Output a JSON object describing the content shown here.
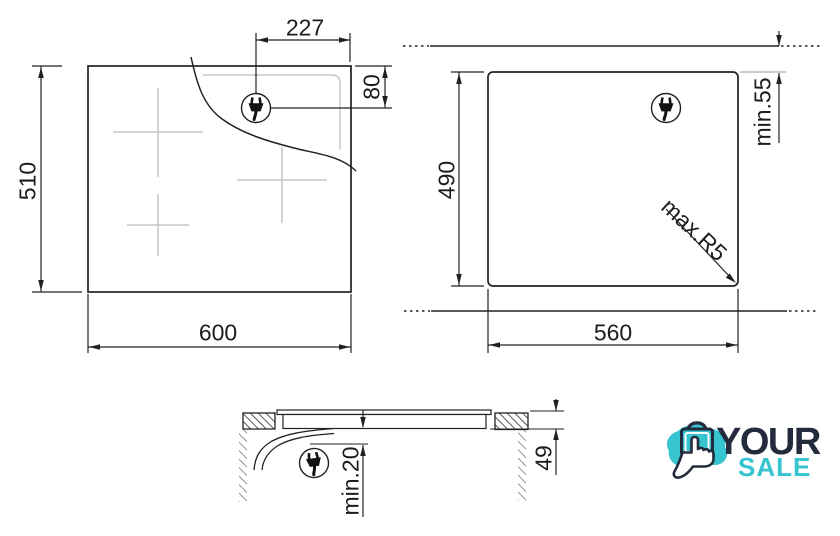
{
  "top_view": {
    "width": "600",
    "height": "510",
    "plug_offset_x": "227",
    "plug_offset_y": "80"
  },
  "cutout_view": {
    "width": "560",
    "height": "490",
    "top_clearance": "min.55",
    "corner_radius": "max.R5"
  },
  "side_view": {
    "total_height": "49",
    "bottom_clearance": "min.20"
  },
  "logo": {
    "line1": "YOUR",
    "line2": "SALE"
  },
  "colors": {
    "line": "#222222",
    "gray_marks": "#c6c6c6",
    "navy": "#232b3c",
    "teal": "#35c4d0"
  },
  "icons": {
    "plug": "power-plug-icon",
    "bag": "shopping-bag-icon",
    "hand": "pointer-hand-icon"
  }
}
